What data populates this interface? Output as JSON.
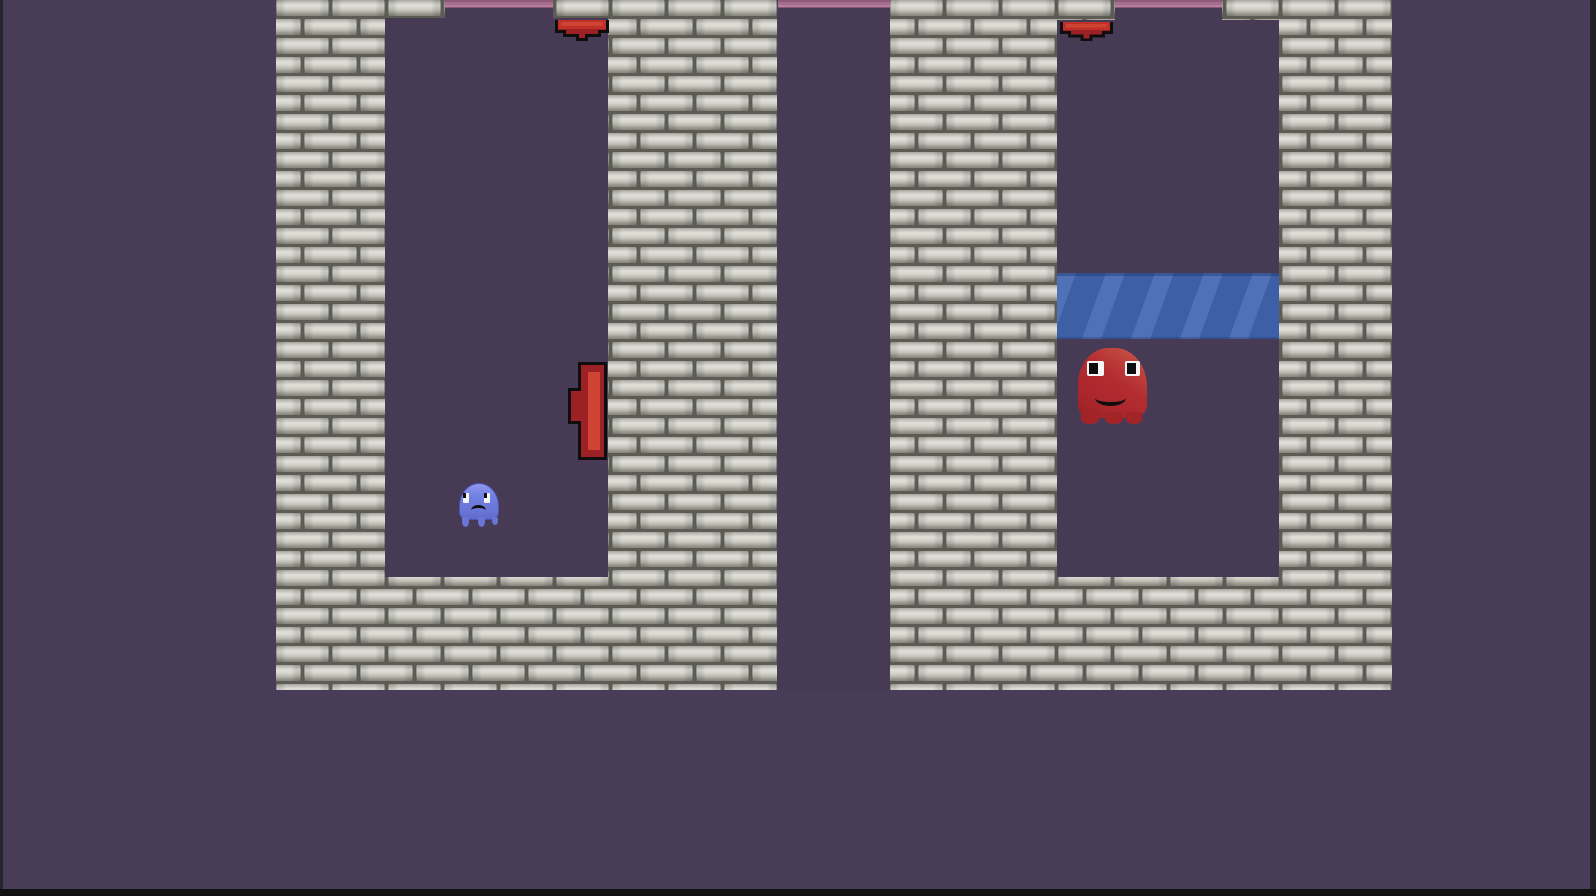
{
  "app": {
    "name": "pixel-ghost-platformer-game",
    "visible_text": "none"
  },
  "palette": {
    "background": "#483c59",
    "room_interior": "#463a55",
    "brick_grout": "#5c5c55",
    "brick_face_light": "#e0e0d8",
    "brick_face_mid": "#c2c2ba",
    "brick_face_dark": "#84847c",
    "pink_ceiling_dark": "#8f5a7a",
    "pink_ceiling_light": "#b57e9b",
    "red_obstacle": "#c03028",
    "red_obstacle_shade": "#9c2125",
    "obstacle_outline": "#0e0e0e",
    "platform_blue": "#3d5fa5",
    "platform_stripe_blue": "#5070b8",
    "ghost_blue_body": "#7280e2",
    "ghost_red_body": "#b32c30",
    "eye_white": "#f4f4f4",
    "screen_edge_dark": "#121212"
  },
  "scene": {
    "viewport": {
      "w": 1596,
      "h": 896
    },
    "brick_tile": {
      "pitch_x": 56,
      "pitch_y": 19,
      "brick_w": 53,
      "brick_h": 16,
      "stagger_offset": 28
    },
    "towers": [
      {
        "name": "left-brick-tower",
        "x": 276,
        "y": 0,
        "w": 501,
        "h": 690
      },
      {
        "name": "right-brick-tower",
        "x": 890,
        "y": 0,
        "w": 502,
        "h": 690
      }
    ],
    "rooms": [
      {
        "name": "left-room",
        "interior": {
          "x": 385,
          "y": 18,
          "w": 223,
          "h": 559
        },
        "top_opening": {
          "x": 445,
          "y": 0,
          "w": 108,
          "h": 18
        }
      },
      {
        "name": "right-room",
        "interior": {
          "x": 1057,
          "y": 20,
          "w": 222,
          "h": 557
        },
        "top_opening": {
          "x": 1115,
          "y": 0,
          "w": 107,
          "h": 20
        }
      }
    ],
    "gap_channel": {
      "x": 778,
      "y": 0,
      "w": 112,
      "h": 690
    },
    "pink_ceilings": [
      {
        "x": 445,
        "y": 0,
        "w": 108,
        "h": 8
      },
      {
        "x": 778,
        "y": 0,
        "w": 112,
        "h": 8
      },
      {
        "x": 1115,
        "y": 0,
        "w": 107,
        "h": 8
      }
    ],
    "red_ceiling_bumpers": [
      {
        "x": 555,
        "y": 20,
        "w": 54,
        "h": 21
      },
      {
        "x": 1060,
        "y": 22,
        "w": 53,
        "h": 19
      }
    ],
    "red_wall_bumper": {
      "x": 568,
      "y": 362,
      "w": 39,
      "h": 98
    },
    "blue_platform": {
      "x": 1057,
      "y": 273,
      "w": 222,
      "h": 66
    },
    "ghosts": [
      {
        "name": "blue-sad-ghost",
        "mood": "sad",
        "x": 458,
        "y": 483,
        "w": 41,
        "h": 44
      },
      {
        "name": "red-happy-ghost",
        "mood": "happy",
        "x": 1078,
        "y": 348,
        "w": 69,
        "h": 76
      }
    ],
    "screen_edges": {
      "left": {
        "x": 0,
        "y": 0,
        "w": 3,
        "h": 896
      },
      "right": {
        "x": 1590,
        "y": 0,
        "w": 6,
        "h": 896
      },
      "bottom": {
        "x": 0,
        "y": 889,
        "w": 1596,
        "h": 7
      }
    }
  }
}
